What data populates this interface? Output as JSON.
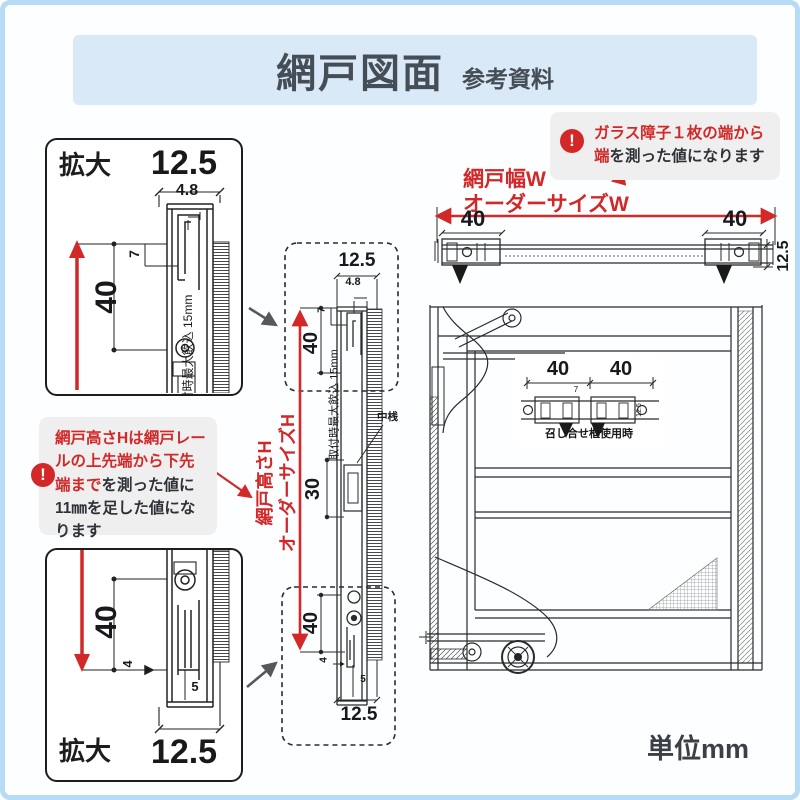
{
  "header": {
    "title": "網戸図面",
    "subtitle": "参考資料"
  },
  "icons": {
    "alert": "!"
  },
  "notes": {
    "width": {
      "line1_red": "ガラス障子１枚の端から",
      "line2_red": "端",
      "line2_black": "を測った値になります"
    },
    "height": {
      "red": "網戸高さHは網戸レールの上先端から下先端まで",
      "black": "を測った値に11㎜を足した値になります"
    }
  },
  "labels": {
    "enlarge": "拡大",
    "screen_width": "網戸幅W",
    "order_width": "オーダーサイズW",
    "screen_height": "網戸高さH",
    "order_height": "オーダーサイズH",
    "mullion": "中桟",
    "meeting_stile": "召し合せ框使用時",
    "max_insertion": "取付時最大飲込 15mm",
    "unit": "単位mm"
  },
  "dims": {
    "frame_width": "12.5",
    "lip": "4.8",
    "hook_depth": "7",
    "forty": "40",
    "mullion_height": "30",
    "bottom_gap": "4",
    "rail_offset": "5"
  },
  "colors": {
    "accent_red": "#d22828",
    "header_bg": "#d9e9f7",
    "note_bg": "#efefef"
  }
}
